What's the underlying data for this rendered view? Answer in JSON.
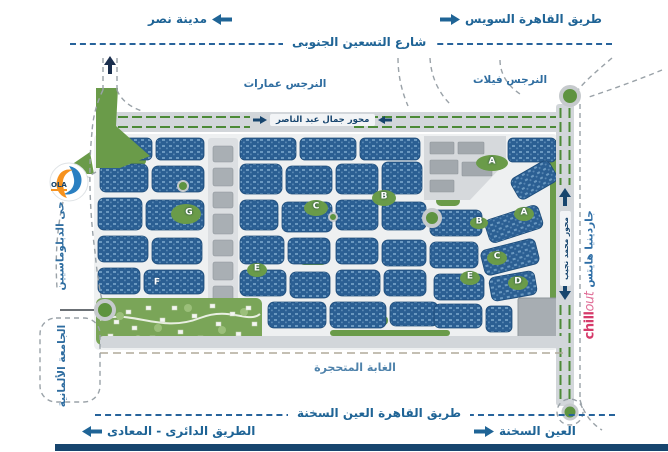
{
  "top": {
    "left_label": "مدينة نصر",
    "right_label": "طريق القاهرة السويس",
    "street_label": "شارع التسعين الجنوبى"
  },
  "map": {
    "labels": {
      "narges_buildings": "النرجس عمارات",
      "narges_villas": "النرجس فيلات",
      "nasser_axis": "محور جمال عبد الناصر",
      "naguib_axis": "محور محمد نجيب",
      "diplomats_district": "حى الدبلوماسيين",
      "german_university": "الجامعة الألمانية",
      "gardenia_heights": "جاردينيا هايتس",
      "petrified_forest": "الغابة المتحجرة"
    },
    "zone_markers": [
      {
        "label": "G",
        "x": 189,
        "y": 213
      },
      {
        "label": "F",
        "x": 157,
        "y": 283
      },
      {
        "label": "E",
        "x": 257,
        "y": 269
      },
      {
        "label": "C",
        "x": 316,
        "y": 207
      },
      {
        "label": "B",
        "x": 384,
        "y": 197
      },
      {
        "label": "A",
        "x": 492,
        "y": 162
      },
      {
        "label": "A",
        "x": 524,
        "y": 213
      },
      {
        "label": "B",
        "x": 479,
        "y": 222
      },
      {
        "label": "C",
        "x": 497,
        "y": 257
      },
      {
        "label": "D",
        "x": 518,
        "y": 282
      },
      {
        "label": "E",
        "x": 470,
        "y": 277
      }
    ],
    "logos": {
      "ola": "OLA",
      "chillout_bold": "chill",
      "chillout_light": "out"
    }
  },
  "bottom": {
    "sokhna_road_label": "طريق القاهرة العين السخنة",
    "ring_road_label": "الطريق الدائرى - المعادى",
    "ain_sokhna_label": "العين السخنة"
  },
  "colors": {
    "label_blue": "#1f6496",
    "dark_navy": "#17456e",
    "block_navy": "#2b5f93",
    "road_gray": "#d2d6da",
    "green": "#6a9b49",
    "median_green": "#4c8a37",
    "chillout_pink": "#d63a6a",
    "ola_orange": "#f6921e",
    "ola_blue": "#2a7fc1"
  }
}
